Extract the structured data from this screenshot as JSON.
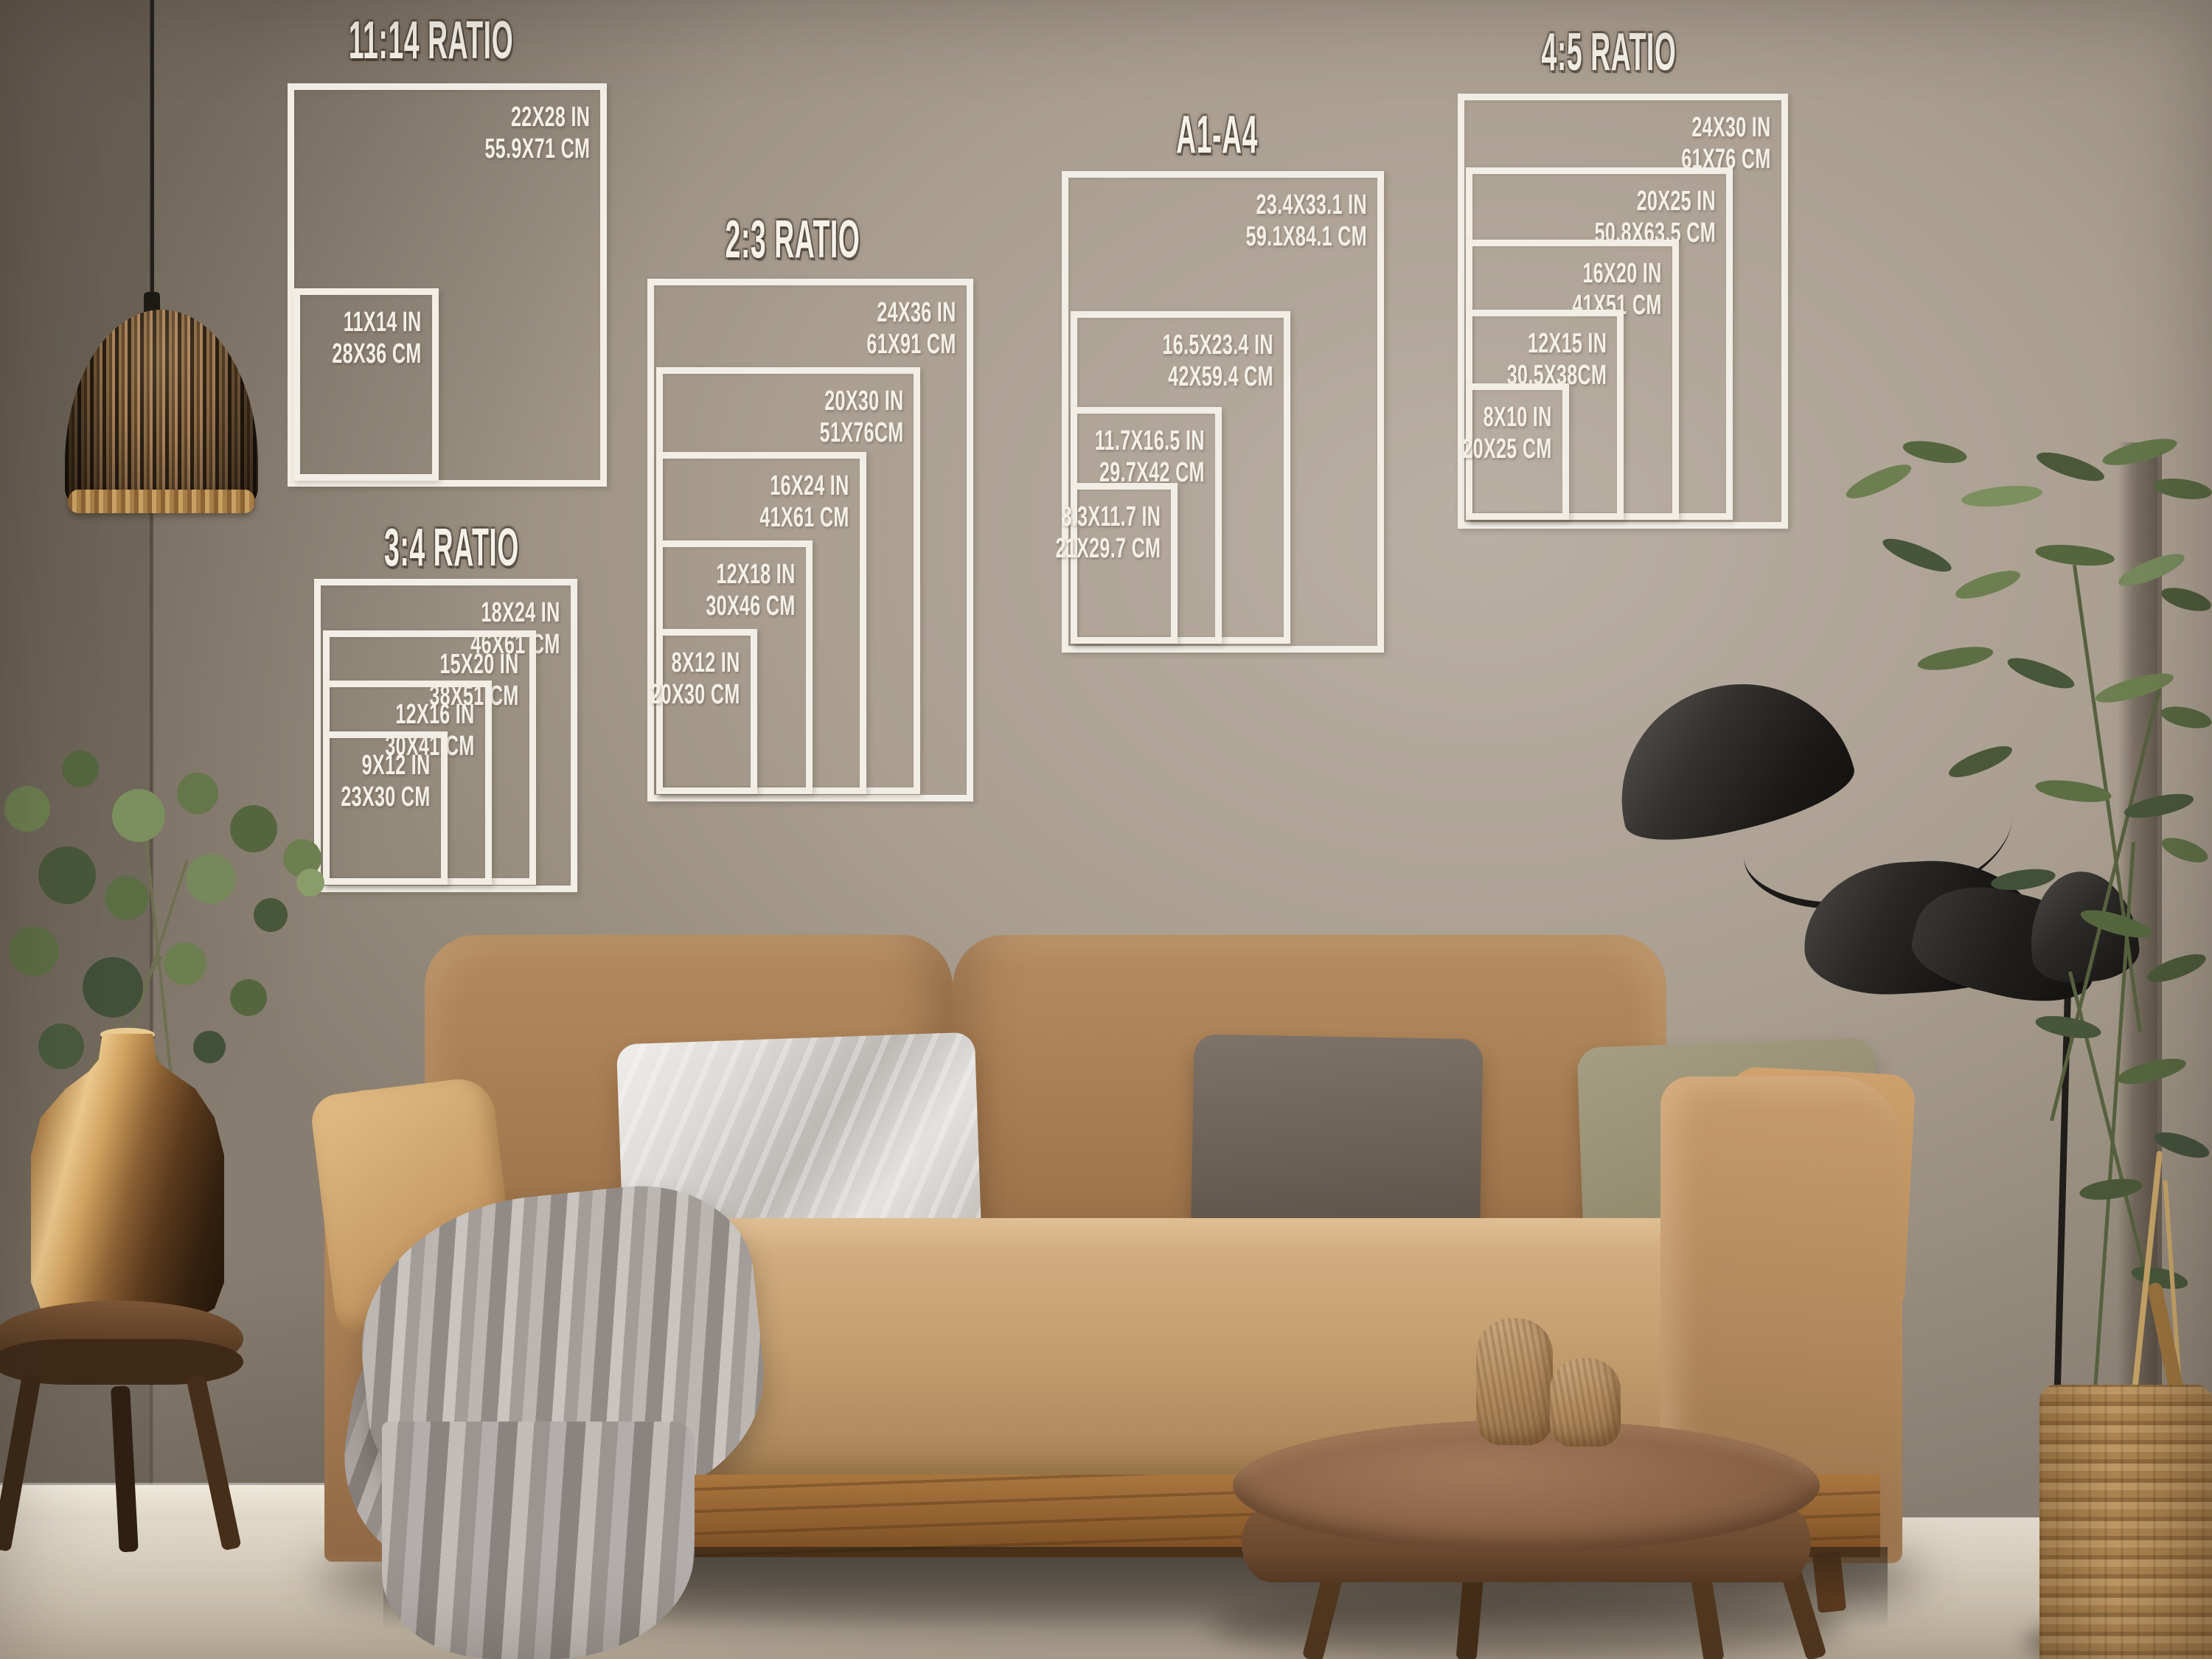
{
  "overlay": {
    "line_color": "#f2eee6",
    "text_color": "#f5f1e9"
  },
  "scene_colors": {
    "wall": "#a99e90",
    "sofa": "#b58c60",
    "floor": "#d3c9b8"
  },
  "size_guide": {
    "groups": [
      {
        "id": "ratio-11-14",
        "title": "11:14 RATIO",
        "sizes": [
          {
            "in": "22X28 IN",
            "cm": "55.9X71 CM"
          },
          {
            "in": "11X14 IN",
            "cm": "28X36 CM"
          }
        ]
      },
      {
        "id": "ratio-3-4",
        "title": "3:4 RATIO",
        "sizes": [
          {
            "in": "18X24 IN",
            "cm": "46X61 CM"
          },
          {
            "in": "15X20 IN",
            "cm": "38X51 CM"
          },
          {
            "in": "12X16 IN",
            "cm": "30X41 CM"
          },
          {
            "in": "9X12 IN",
            "cm": "23X30 CM"
          }
        ]
      },
      {
        "id": "ratio-2-3",
        "title": "2:3 RATIO",
        "sizes": [
          {
            "in": "24X36 IN",
            "cm": "61X91 CM"
          },
          {
            "in": "20X30 IN",
            "cm": "51X76CM"
          },
          {
            "in": "16X24 IN",
            "cm": "41X61 CM"
          },
          {
            "in": "12X18 IN",
            "cm": "30X46 CM"
          },
          {
            "in": "8X12 IN",
            "cm": "20X30 CM"
          }
        ]
      },
      {
        "id": "a-series",
        "title": "A1-A4",
        "sizes": [
          {
            "in": "23.4X33.1 IN",
            "cm": "59.1X84.1 CM"
          },
          {
            "in": "16.5X23.4 IN",
            "cm": "42X59.4 CM"
          },
          {
            "in": "11.7X16.5 IN",
            "cm": "29.7X42 CM"
          },
          {
            "in": "8.3X11.7 IN",
            "cm": "21X29.7 CM"
          }
        ]
      },
      {
        "id": "ratio-4-5",
        "title": "4:5 RATIO",
        "sizes": [
          {
            "in": "24X30 IN",
            "cm": "61X76 CM"
          },
          {
            "in": "20X25 IN",
            "cm": "50.8X63.5 CM"
          },
          {
            "in": "16X20 IN",
            "cm": "41X51 CM"
          },
          {
            "in": "12X15 IN",
            "cm": "30.5X38CM"
          },
          {
            "in": "8X10 IN",
            "cm": "20X25 CM"
          }
        ]
      }
    ]
  }
}
